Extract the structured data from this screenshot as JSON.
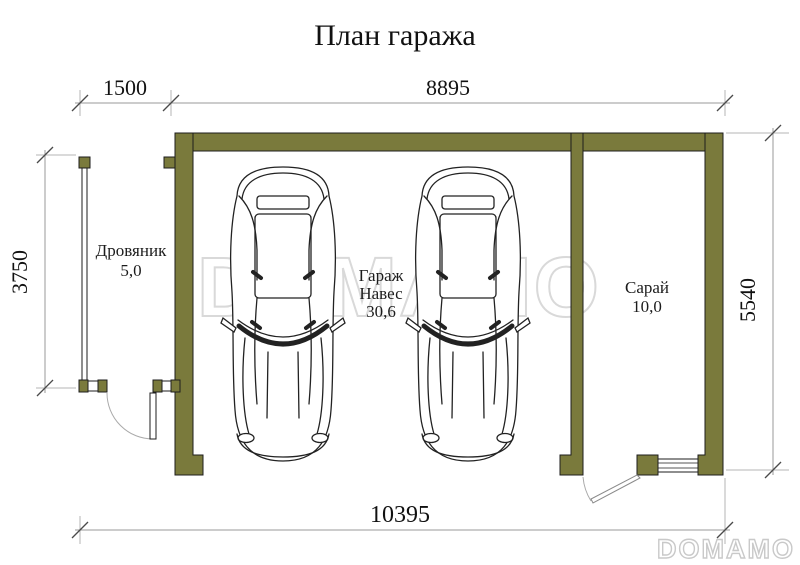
{
  "title": "План гаража",
  "dimensions": {
    "top_left": "1500",
    "top_main": "8895",
    "left": "3750",
    "right": "5540",
    "bottom": "10395"
  },
  "rooms": {
    "woodshed": {
      "name": "Дровяник",
      "area": "5,0"
    },
    "garage": {
      "name": "Гараж",
      "subtype": "Навес",
      "area": "30,6"
    },
    "shed": {
      "name": "Сарай",
      "area": "10,0"
    }
  },
  "watermarks": {
    "center": "DOMAMO",
    "corner": "DOMAMO"
  },
  "colors": {
    "wall": "#7a7a3c",
    "line": "#1d1d1d",
    "dimension": "#9a9a9a",
    "watermark_center": "#d9d9d9",
    "watermark_corner": "#c9c9c9"
  }
}
